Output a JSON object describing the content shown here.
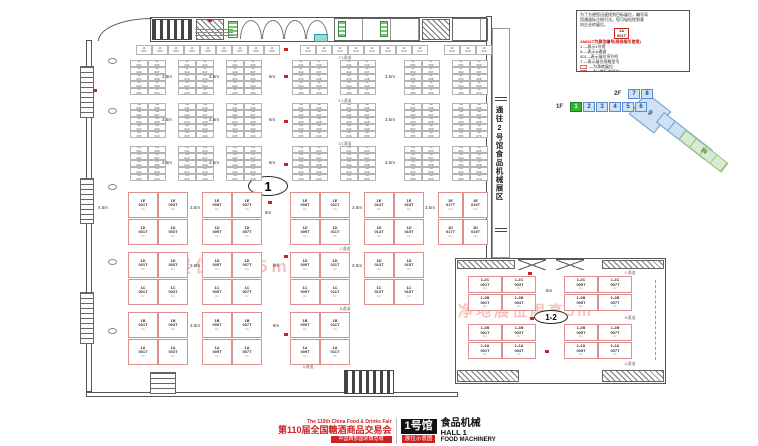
{
  "legend": {
    "intro_lines": [
      "为了方便您迅速找到目标展位，编号采",
      "用通道标注指引法，您可轻松找到意",
      "向企业的展位。"
    ],
    "example": {
      "top": "1A",
      "bottom": "001T"
    },
    "code_note": "1A001T为展位编号(现场指引使用)",
    "code_lines": [
      "1 —表示1号馆",
      "A —表示A通道",
      "001—表示展位序列号",
      "T —表示展位规格型号"
    ],
    "swatches": [
      {
        "color": "#ffffff",
        "label": "为净地展位"
      },
      {
        "color": "#ffe8e8",
        "label": "为A类标准展位"
      },
      {
        "color": "#e8f0ff",
        "label": "为B类标准展位"
      },
      {
        "color": "#e8ffe8",
        "label": "为C类标准展位"
      }
    ],
    "warning1": "红色编号展位为重点推荐展位",
    "warning2": "展位内有立柱，限高为3.5m"
  },
  "navigator": {
    "floor2_label": "2F",
    "floor2_cells": [
      "7",
      "8"
    ],
    "floor1_label": "1F",
    "floor1_cells": [
      "1",
      "2",
      "3",
      "4",
      "5",
      "6"
    ],
    "active_cell": "1",
    "diag_a": "9",
    "diag_b": "10"
  },
  "corridor_text": "通往2号馆食品机械展区",
  "watermark_text": "净地展位限高5m",
  "oval_main": "1",
  "oval_annex": "1-2",
  "footer": {
    "fair_en": "The 110th China Food & Drinks Fair",
    "fair_cn": "第110届全国糖酒商品交易会",
    "venue": "中国西部国际博览城",
    "hall_badge": "1号馆",
    "badge_sub": "展位示意图",
    "hall_cn": "食品机械",
    "hall_en": "HALL 1",
    "hall_en2": "FOOD MACHINERY"
  },
  "dim_labels": [
    {
      "t": "3.5m",
      "x": 167,
      "y": 74
    },
    {
      "t": "3.5m",
      "x": 214,
      "y": 74
    },
    {
      "t": "6m",
      "x": 272,
      "y": 74
    },
    {
      "t": "3.5m",
      "x": 390,
      "y": 74
    },
    {
      "t": "3.5m",
      "x": 167,
      "y": 117
    },
    {
      "t": "3.5m",
      "x": 214,
      "y": 117
    },
    {
      "t": "6m",
      "x": 272,
      "y": 117
    },
    {
      "t": "3.5m",
      "x": 390,
      "y": 117
    },
    {
      "t": "3.5m",
      "x": 167,
      "y": 160
    },
    {
      "t": "3.5m",
      "x": 214,
      "y": 160
    },
    {
      "t": "6m",
      "x": 272,
      "y": 160
    },
    {
      "t": "3.5m",
      "x": 390,
      "y": 160
    },
    {
      "t": "4.5m",
      "x": 103,
      "y": 205
    },
    {
      "t": "3.5m",
      "x": 195,
      "y": 205
    },
    {
      "t": "6m",
      "x": 268,
      "y": 210
    },
    {
      "t": "3.5m",
      "x": 357,
      "y": 205
    },
    {
      "t": "3.5m",
      "x": 430,
      "y": 205
    },
    {
      "t": "3.5m",
      "x": 195,
      "y": 263
    },
    {
      "t": "6m",
      "x": 276,
      "y": 263
    },
    {
      "t": "3.5m",
      "x": 357,
      "y": 263
    },
    {
      "t": "3.5m",
      "x": 195,
      "y": 323
    },
    {
      "t": "6m",
      "x": 276,
      "y": 323
    },
    {
      "t": "5m",
      "x": 549,
      "y": 288
    }
  ],
  "aisle_labels": [
    {
      "t": "F1通道",
      "x": 345,
      "y": 55
    },
    {
      "t": "E1通道",
      "x": 345,
      "y": 98
    },
    {
      "t": "D1通道",
      "x": 345,
      "y": 141
    },
    {
      "t": "C通道",
      "x": 345,
      "y": 246
    },
    {
      "t": "B通道",
      "x": 345,
      "y": 306
    },
    {
      "t": "A通道",
      "x": 308,
      "y": 364
    },
    {
      "t": "C通道",
      "x": 630,
      "y": 270
    },
    {
      "t": "B通道",
      "x": 630,
      "y": 315
    },
    {
      "t": "A通道",
      "x": 630,
      "y": 361
    }
  ],
  "floorplan": {
    "top_row": {
      "y": 45,
      "h": 10,
      "cell_w": 16,
      "prefix": "1F",
      "runs": [
        {
          "x": 136,
          "n": 9
        },
        {
          "x": 300,
          "n": 8
        },
        {
          "x": 444,
          "n": 3
        }
      ]
    },
    "small_bands": [
      {
        "y": 60,
        "rows": 5,
        "row_h": 7,
        "cell_w": 18,
        "prefix": "1F",
        "groups": [
          130,
          178,
          226,
          292,
          340,
          404,
          452
        ]
      },
      {
        "y": 103,
        "rows": 5,
        "row_h": 7,
        "cell_w": 18,
        "prefix": "1E",
        "groups": [
          130,
          178,
          226,
          292,
          340,
          404,
          452
        ]
      },
      {
        "y": 146,
        "rows": 5,
        "row_h": 7,
        "cell_w": 18,
        "prefix": "1D",
        "groups": [
          130,
          178,
          226,
          292,
          340,
          404,
          452
        ]
      }
    ],
    "large_rows": [
      {
        "y": 192,
        "h": 26,
        "prefix": "1E",
        "groups": [
          {
            "x": 128,
            "w": 60
          },
          {
            "x": 202,
            "w": 60
          },
          {
            "x": 290,
            "w": 60
          },
          {
            "x": 364,
            "w": 60
          },
          {
            "x": 438,
            "w": 50
          }
        ]
      },
      {
        "y": 219,
        "h": 26,
        "prefix": "1D",
        "groups": [
          {
            "x": 128,
            "w": 60
          },
          {
            "x": 202,
            "w": 60
          },
          {
            "x": 290,
            "w": 60
          },
          {
            "x": 364,
            "w": 60
          },
          {
            "x": 438,
            "w": 50
          }
        ]
      },
      {
        "y": 252,
        "h": 26,
        "prefix": "1D",
        "groups": [
          {
            "x": 128,
            "w": 60
          },
          {
            "x": 202,
            "w": 60
          },
          {
            "x": 290,
            "w": 60
          },
          {
            "x": 364,
            "w": 60
          }
        ]
      },
      {
        "y": 279,
        "h": 26,
        "prefix": "1C",
        "groups": [
          {
            "x": 128,
            "w": 60
          },
          {
            "x": 202,
            "w": 60
          },
          {
            "x": 290,
            "w": 60
          },
          {
            "x": 364,
            "w": 60
          }
        ]
      },
      {
        "y": 312,
        "h": 26,
        "prefix": "1B",
        "groups": [
          {
            "x": 128,
            "w": 60
          },
          {
            "x": 202,
            "w": 60
          },
          {
            "x": 290,
            "w": 60
          }
        ]
      },
      {
        "y": 339,
        "h": 26,
        "prefix": "1A",
        "groups": [
          {
            "x": 128,
            "w": 60
          },
          {
            "x": 202,
            "w": 60
          },
          {
            "x": 290,
            "w": 60
          }
        ]
      }
    ],
    "annex_rows": [
      {
        "y": 276,
        "h": 17,
        "prefix": "1-2C",
        "groups": [
          {
            "x": 468,
            "w": 68
          },
          {
            "x": 564,
            "w": 68
          }
        ]
      },
      {
        "y": 294,
        "h": 17,
        "prefix": "1-2B",
        "groups": [
          {
            "x": 468,
            "w": 68
          },
          {
            "x": 564,
            "w": 68
          }
        ]
      },
      {
        "y": 324,
        "h": 17,
        "prefix": "1-2B",
        "groups": [
          {
            "x": 468,
            "w": 68
          },
          {
            "x": 564,
            "w": 68
          }
        ]
      },
      {
        "y": 342,
        "h": 17,
        "prefix": "1-2A",
        "groups": [
          {
            "x": 468,
            "w": 68
          },
          {
            "x": 564,
            "w": 68
          }
        ]
      }
    ],
    "red_dots": [
      [
        284,
        48
      ],
      [
        284,
        75
      ],
      [
        284,
        120
      ],
      [
        284,
        163
      ],
      [
        268,
        201
      ],
      [
        284,
        255
      ],
      [
        284,
        333
      ],
      [
        528,
        272
      ],
      [
        530,
        317
      ],
      [
        545,
        350
      ],
      [
        93,
        89
      ],
      [
        208,
        19
      ]
    ],
    "pillars": [
      [
        108,
        58
      ],
      [
        108,
        108
      ],
      [
        108,
        184
      ],
      [
        108,
        259
      ],
      [
        108,
        328
      ]
    ]
  }
}
